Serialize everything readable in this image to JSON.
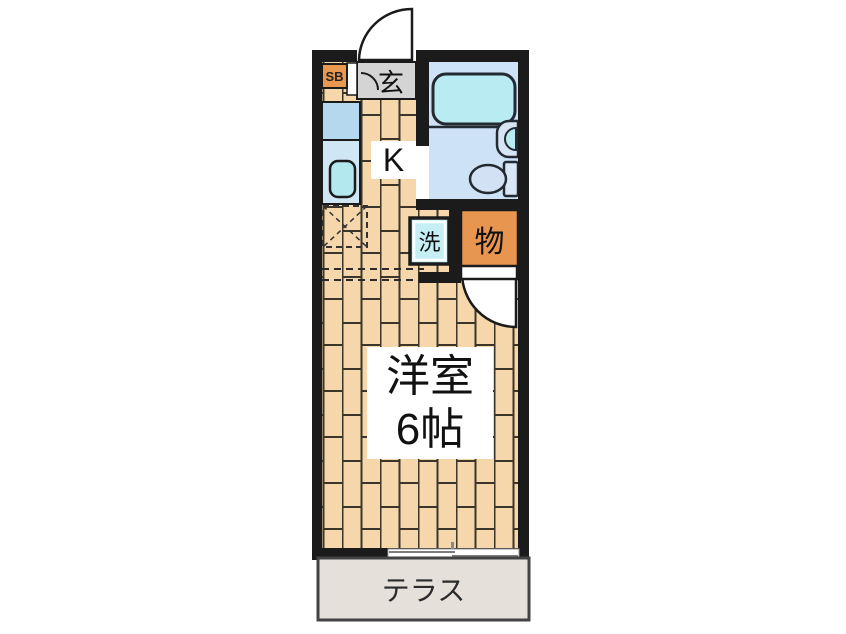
{
  "floorplan": {
    "labels": {
      "shoe_box": "SB",
      "entrance": "玄",
      "kitchen": "K",
      "laundry": "洗",
      "storage": "物",
      "main_room_name": "洋室",
      "main_room_size": "6帖",
      "terrace": "テラス"
    },
    "colors": {
      "wall": "#1b1b1b",
      "wood_floor": "#f5d7ab",
      "wood_joint": "#3c352a",
      "bath_floor": "#cde2f5",
      "bathtub": "#b9ecf2",
      "fixture_blue": "#d6e4f4",
      "counter_blue_upper": "#b5d8ee",
      "counter_blue_lower": "#cfe6f5",
      "kitchen_sink": "#b2e8ee",
      "accent_orange": "#e8964f",
      "laundry_cyan": "#c6eef5",
      "entrance_gray": "#d4d4d4",
      "terrace_gray": "#e5e0d9"
    }
  }
}
